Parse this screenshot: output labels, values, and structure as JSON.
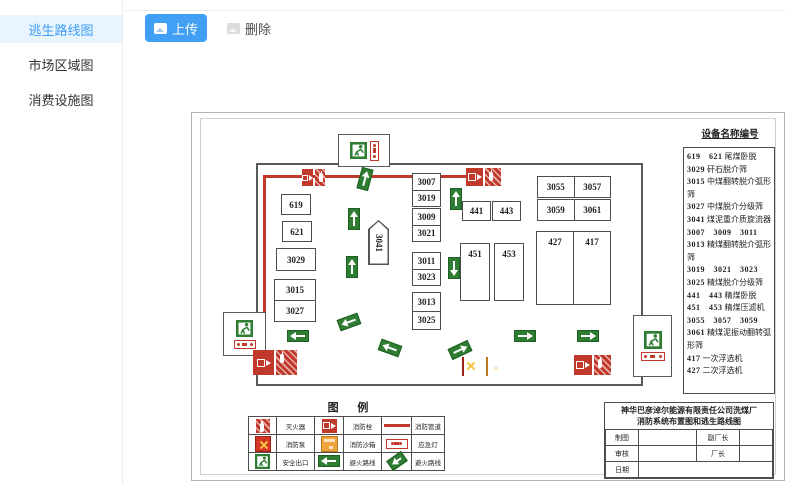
{
  "sidebar": {
    "items": [
      {
        "label": "逃生路线图",
        "active": true
      },
      {
        "label": "市场区域图",
        "active": false
      },
      {
        "label": "消费设施图",
        "active": false
      }
    ]
  },
  "toolbar": {
    "upload_label": "上传",
    "delete_label": "删除"
  },
  "colors": {
    "accent_blue": "#41a0f5",
    "active_item_bg": "#e8f4fe",
    "route_red": "#c0392b",
    "route_green": "#2e7d32",
    "sandbox_orange": "#f0a53c"
  },
  "icons": {
    "upload": "image-icon",
    "delete": "image-icon",
    "exit": "running-man-exit",
    "hydrant": "fire-hydrant",
    "extinguisher": "fire-extinguisher",
    "pump": "fire-pump",
    "sandbox": "fire-sandbox",
    "emergency_light": "emergency-light",
    "route_arrow": "green-arrow"
  },
  "diagram": {
    "boxes": {
      "left": [
        "619",
        "621",
        "3029"
      ],
      "stack": [
        "3015",
        "3027"
      ],
      "pentagon": "3041",
      "mid_pairs": [
        [
          "3007",
          "3019"
        ],
        [
          "3009",
          "3021"
        ],
        [
          "3011",
          "3023"
        ],
        [
          "3013",
          "3025"
        ]
      ],
      "p441": [
        "441",
        "443"
      ],
      "p451": [
        "451",
        "453"
      ],
      "p3055": [
        "3055",
        "3057"
      ],
      "p3059": [
        "3059",
        "3061"
      ],
      "p427": [
        "427",
        "417"
      ]
    },
    "equipment_panel": {
      "title": "设备名称编号",
      "items": [
        {
          "nums": "619　621",
          "name": "尾煤卧脱"
        },
        {
          "nums": "3029",
          "name": "矸石脱介筛"
        },
        {
          "nums": "3015",
          "name": "中煤翻转脱介弧形筛"
        },
        {
          "nums": "3027",
          "name": "中煤脱介分级筛"
        },
        {
          "nums": "3041",
          "name": "煤泥重介质旋流器"
        },
        {
          "nums": "3007　3009　3011　3013",
          "name": "精煤翻转脱介弧形筛"
        },
        {
          "nums": "3019　3021　3023　3025",
          "name": "精煤脱介分级筛"
        },
        {
          "nums": "441　443",
          "name": "精煤卧脱"
        },
        {
          "nums": "451　453",
          "name": "精煤压滤机"
        },
        {
          "nums": "3055　3057　3059　3061",
          "name": "精煤泥振动翻转弧形筛"
        },
        {
          "nums": "417",
          "name": "一次浮选机"
        },
        {
          "nums": "427",
          "name": "二次浮选机"
        }
      ]
    },
    "legend": {
      "title": "图 例",
      "entries": [
        {
          "icon": "fire-extinguisher",
          "label": "灭火器"
        },
        {
          "icon": "fire-hydrant",
          "label": "消防栓"
        },
        {
          "icon": "fire-pipe",
          "label": "消防管道"
        },
        {
          "icon": "fire-pump",
          "label": "消防泵"
        },
        {
          "icon": "fire-sandbox",
          "label": "消防沙箱"
        },
        {
          "icon": "emergency-light",
          "label": "应急灯"
        },
        {
          "icon": "safety-exit",
          "label": "安全出口"
        },
        {
          "icon": "route-arrow-left",
          "label": "避火路线"
        },
        {
          "icon": "route-arrow-diagonal",
          "label": "避火路线"
        }
      ]
    },
    "title_block": {
      "line1": "神华巴彦淖尔能源有限责任公司洗煤厂",
      "line2": "消防系统布置图和逃生路线图",
      "fields": {
        "draw": "制图",
        "deputy": "副厂长",
        "review": "审核",
        "director": "厂长",
        "date": "日期"
      }
    }
  }
}
